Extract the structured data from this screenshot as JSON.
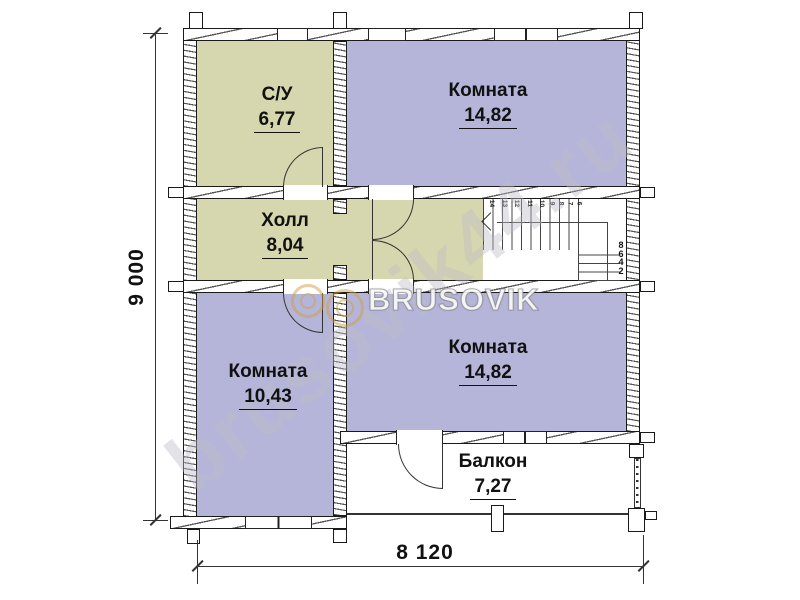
{
  "plan": {
    "rooms": {
      "bathroom": {
        "name": "С/У",
        "area": "6,77"
      },
      "room_top": {
        "name": "Комната",
        "area": "14,82"
      },
      "hall": {
        "name": "Холл",
        "area": "8,04"
      },
      "room_left": {
        "name": "Комната",
        "area": "10,43"
      },
      "room_bottom": {
        "name": "Комната",
        "area": "14,82"
      },
      "balcony": {
        "name": "Балкон",
        "area": "7,27"
      }
    },
    "dimensions": {
      "height_label": "9 000",
      "width_label": "8 120"
    },
    "stairs": {
      "upper_step_labels": [
        "14",
        "13",
        "12",
        "11",
        "10",
        "9",
        "8",
        "7",
        "6"
      ],
      "lower_step_labels": [
        "8",
        "6",
        "4",
        "2"
      ]
    },
    "colors": {
      "service_room_fill": "#d7d7af",
      "living_room_fill": "#b5b5d9",
      "wall_line": "#1a1a1a",
      "watermark_gold": "#cda041"
    }
  },
  "watermark": {
    "diagonal_text": "brusovik44.ru",
    "logo_text": "BRUSOVIK"
  }
}
